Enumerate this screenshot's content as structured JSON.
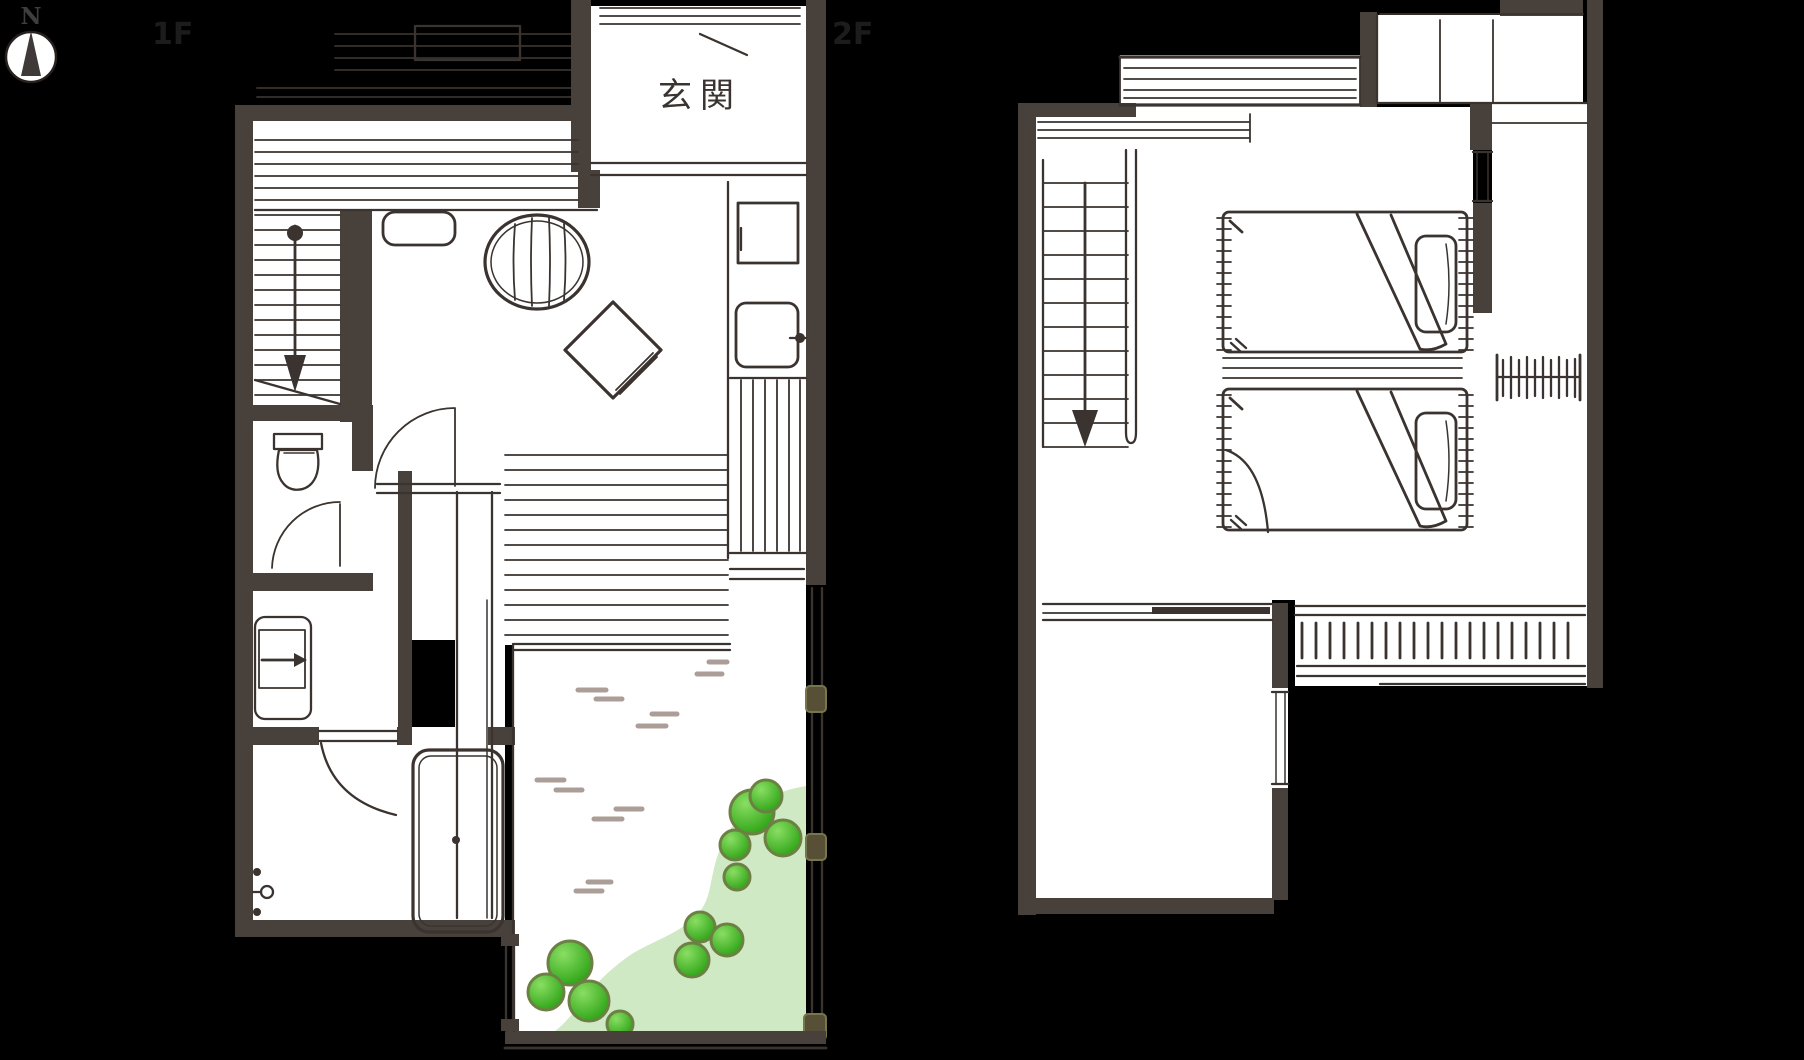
{
  "title": "hand-drawn two-story Japanese house floor plan",
  "compass": {
    "letter": "N"
  },
  "floors": {
    "first": {
      "label": "1F",
      "entrance_label": "玄関",
      "features": [
        "engawa-deck",
        "staircase-down",
        "round-table",
        "floor-cushion",
        "kitchen-sink",
        "kitchen-stove",
        "kitchen-counter",
        "toilet",
        "washbasin",
        "bathtub",
        "bathroom",
        "terrace-sliding-door",
        "garden",
        "stepping-stone-strokes",
        "bushes",
        "lawn-patch",
        "fence-posts"
      ]
    },
    "second": {
      "label": "2F",
      "features": [
        "staircase-down",
        "window-band",
        "twin-bed-1",
        "twin-bed-2",
        "pillows",
        "folded-blankets",
        "nightstand",
        "closet-hanger-rod",
        "top-closet",
        "sliding-partition",
        "balcony-railing",
        "small-windows"
      ]
    }
  },
  "colors": {
    "background": "#000000",
    "wall": "#48403a",
    "sketch_line": "#3a332f",
    "room_fill": "#ffffff",
    "stepping_stroke": "#ab9d97",
    "bush_green": "#3fb527",
    "bush_outline": "#6d8044",
    "lawn_green": "#cfe9c4",
    "fence_post": "#575036"
  }
}
